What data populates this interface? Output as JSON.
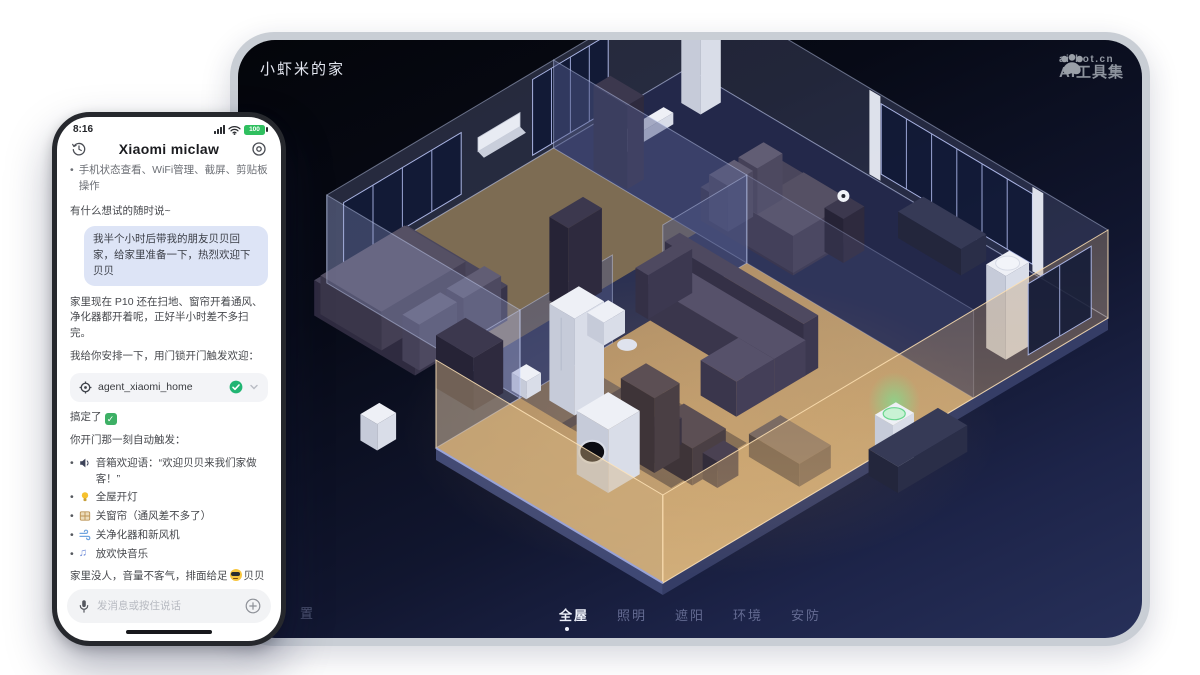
{
  "app": {
    "title": "小虾米的家"
  },
  "watermark": {
    "line1": "ai-bot.cn",
    "line2": "AI工具集"
  },
  "tabs": {
    "items": [
      {
        "label": "全屋"
      },
      {
        "label": "照明"
      },
      {
        "label": "遮阳"
      },
      {
        "label": "环境"
      },
      {
        "label": "安防"
      }
    ]
  },
  "partial_label": "置",
  "phone": {
    "status": {
      "time": "8:16",
      "battery": "100"
    },
    "header": {
      "title": "Xiaomi miclaw"
    },
    "intro_bullet": "手机状态查看、WiFi管理、截屏、剪贴板操作",
    "greeting": "有什么想试的随时说~",
    "user_message": "我半个小时后带我的朋友贝贝回家，给家里准备一下，热烈欢迎下贝贝",
    "reply_1": "家里现在 P10 还在扫地、窗帘开着通风、净化器都开着呢，正好半小时差不多扫完。",
    "reply_2": "我给你安排一下，用门锁开门触发欢迎：",
    "agent_chip": {
      "label": "agent_xiaomi_home"
    },
    "done_text": "搞定了",
    "trigger_heading": "你开门那一刻自动触发：",
    "trigger_items": [
      {
        "icon": "speaker-icon",
        "text": "音箱欢迎语：“欢迎贝贝来我们家做客！”"
      },
      {
        "icon": "bulb-icon",
        "text": "全屋开灯"
      },
      {
        "icon": "curtain-icon",
        "text": "关窗帘（通风差不多了）"
      },
      {
        "icon": "wind-icon",
        "text": "关净化器和新风机"
      },
      {
        "icon": "music-icon",
        "text": "放欢快音乐"
      }
    ],
    "closing_pre": "家里没人，音量不客气，排面给足",
    "closing_post": "贝贝一进门就有仪式感！",
    "input": {
      "placeholder": "发消息或按住说话"
    }
  },
  "colors": {
    "accent_green": "#21b573",
    "bubble_blue": "#dde4f6",
    "living_amber": "#c4a577",
    "panel_navy": "#1d2449"
  }
}
